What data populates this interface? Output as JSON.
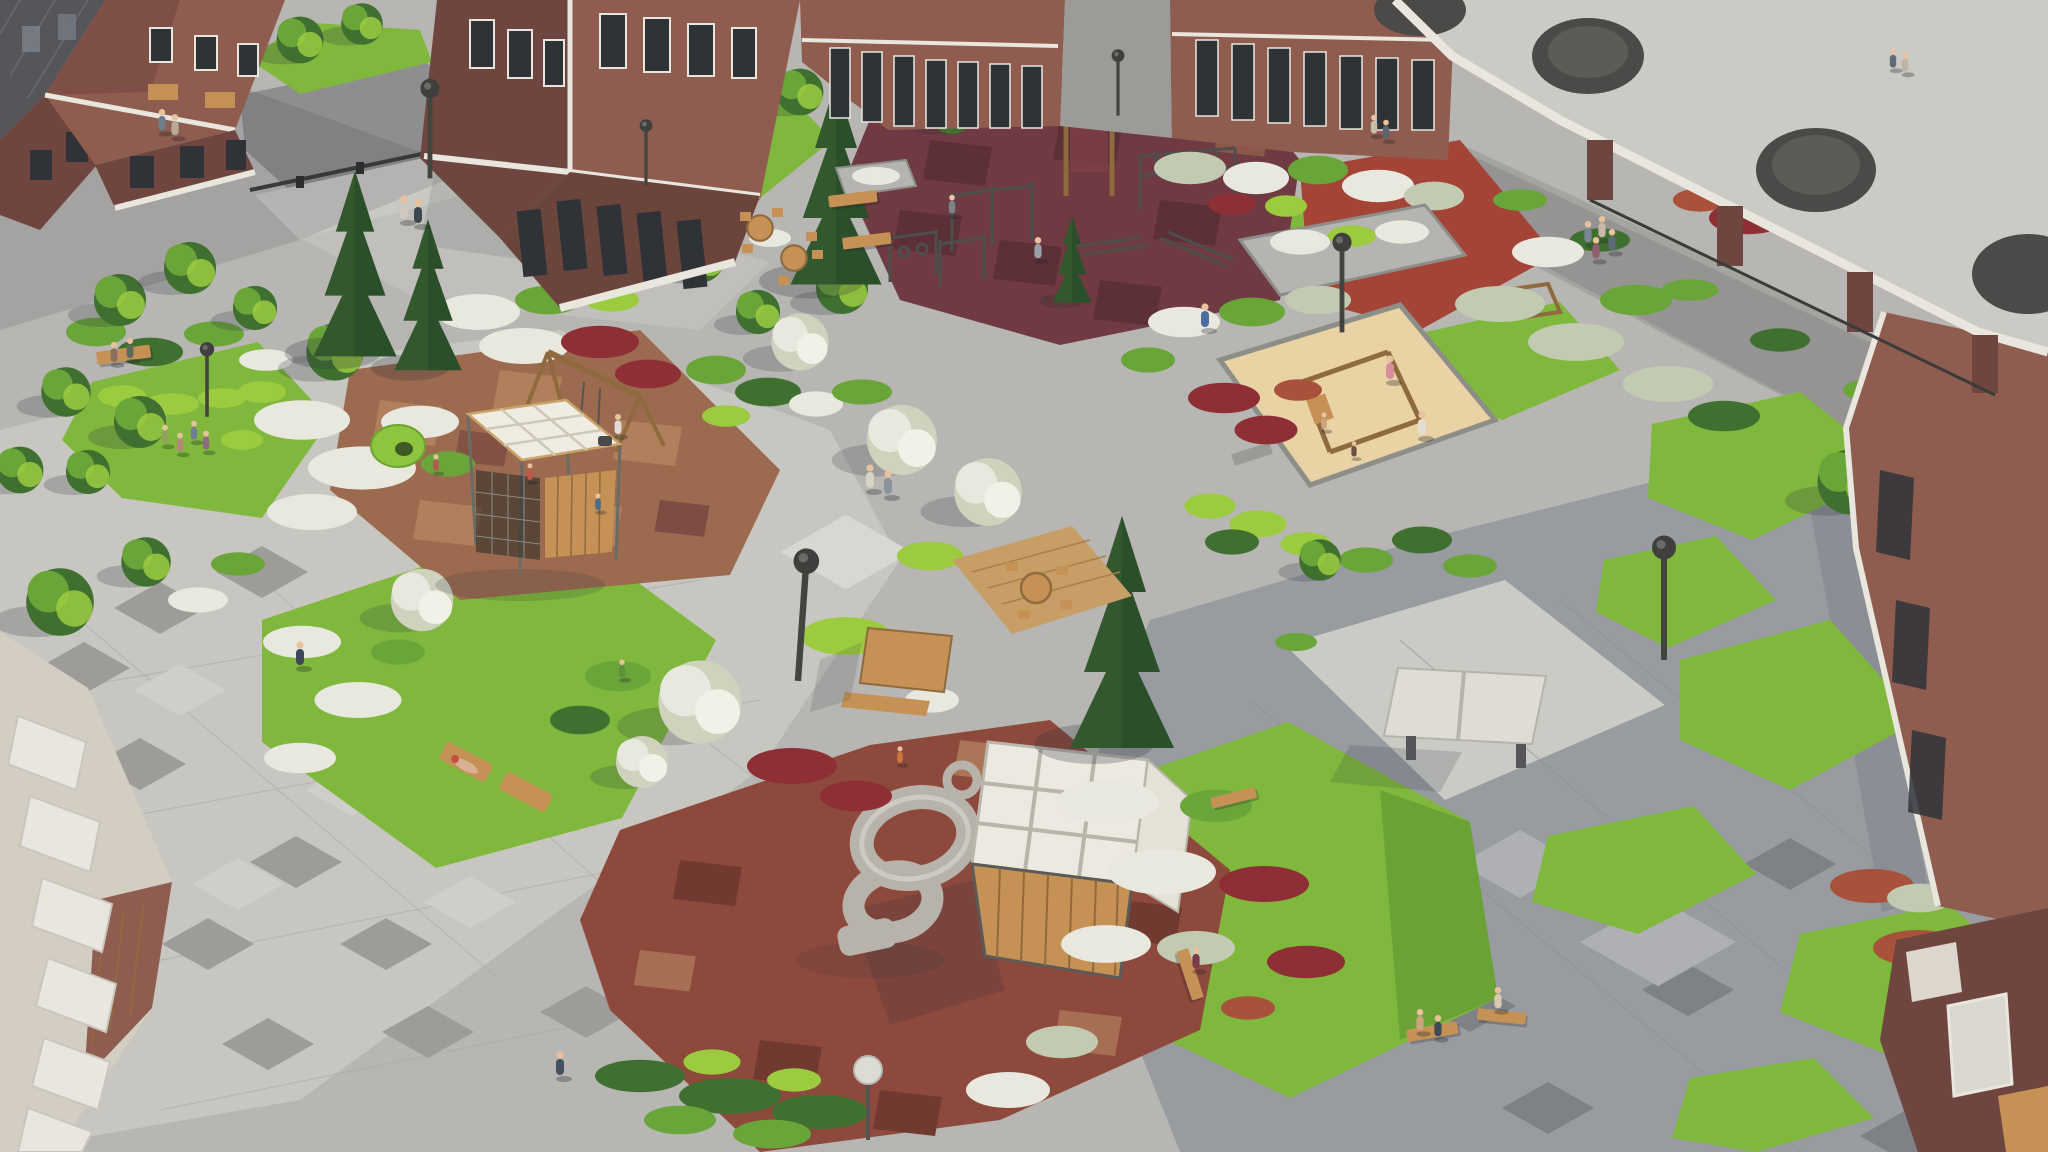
{
  "scene": {
    "alt": "Aerial render of a residential courtyard with brick apartment buildings, pergola with round skylights, lawns, flowering shrubs, workout area, kids playgrounds, sandbox, spiral slide, table tennis and seating",
    "objects": [
      "apartment-building",
      "pergola-canopy",
      "workout-area",
      "kids-playground",
      "sandbox",
      "spiral-slide",
      "play-cube",
      "table-tennis",
      "lawn",
      "flower-bed",
      "bench",
      "street-lamp",
      "pedestrian",
      "paving-plaza"
    ]
  },
  "palette": {
    "paving_mid": "#b7b6b2",
    "paving_light": "#c7c6c1",
    "paving_pale": "#d8d7d1",
    "paving_cool": "#989ba0",
    "paving_cool_light": "#aeb0b3",
    "paving_shade": "#a5a4a1",
    "asphalt": "#8e8e90",
    "gravel": "#c9cbc4",
    "tile_dark": "#9d9c98",
    "tile_light": "#cfcec9",
    "tile_deep": "#7e8287",
    "seam": "#a8a7a3",
    "seam_cool": "#8b8e93",
    "lawn": "#7fb83c",
    "lawn_shade": "#5d9330",
    "leaf": "#6aa53a",
    "leaf_dark": "#3f7030",
    "leaf_lime": "#9ccb40",
    "conifer": "#33582e",
    "conifer_dark": "#27482a",
    "bush_white": "#e9e8df",
    "bush_silver": "#c2cbb2",
    "bush_red": "#8e2f35",
    "bush_rust": "#a8523c",
    "graphite": "#55555a",
    "brick": "#8f5c50",
    "brick_dark": "#6f463f",
    "brick_light": "#9d6b5d",
    "window_dark": "#2f3338",
    "trim": "#e9e6dd",
    "wood": "#c59155",
    "wood_dark": "#8f6a3f",
    "metal": "#4e4e4c",
    "fence": "#3b3b3a",
    "rubber_maroon": "#6f3a41",
    "rubber_maroon_dark": "#5d3038",
    "rubber_brown": "#9c6a4f",
    "rubber_tan": "#b07f5c",
    "rubber_red": "#8d4a3c",
    "rubber_red_dark": "#703a30",
    "red_court": "#a34437",
    "sand": "#e9d2a4",
    "slide_gray": "#b8b3aa",
    "white_struct": "#ece9e0",
    "skin": "#e8c19e",
    "shadow_color": "rgba(42,46,60,0.24)"
  }
}
